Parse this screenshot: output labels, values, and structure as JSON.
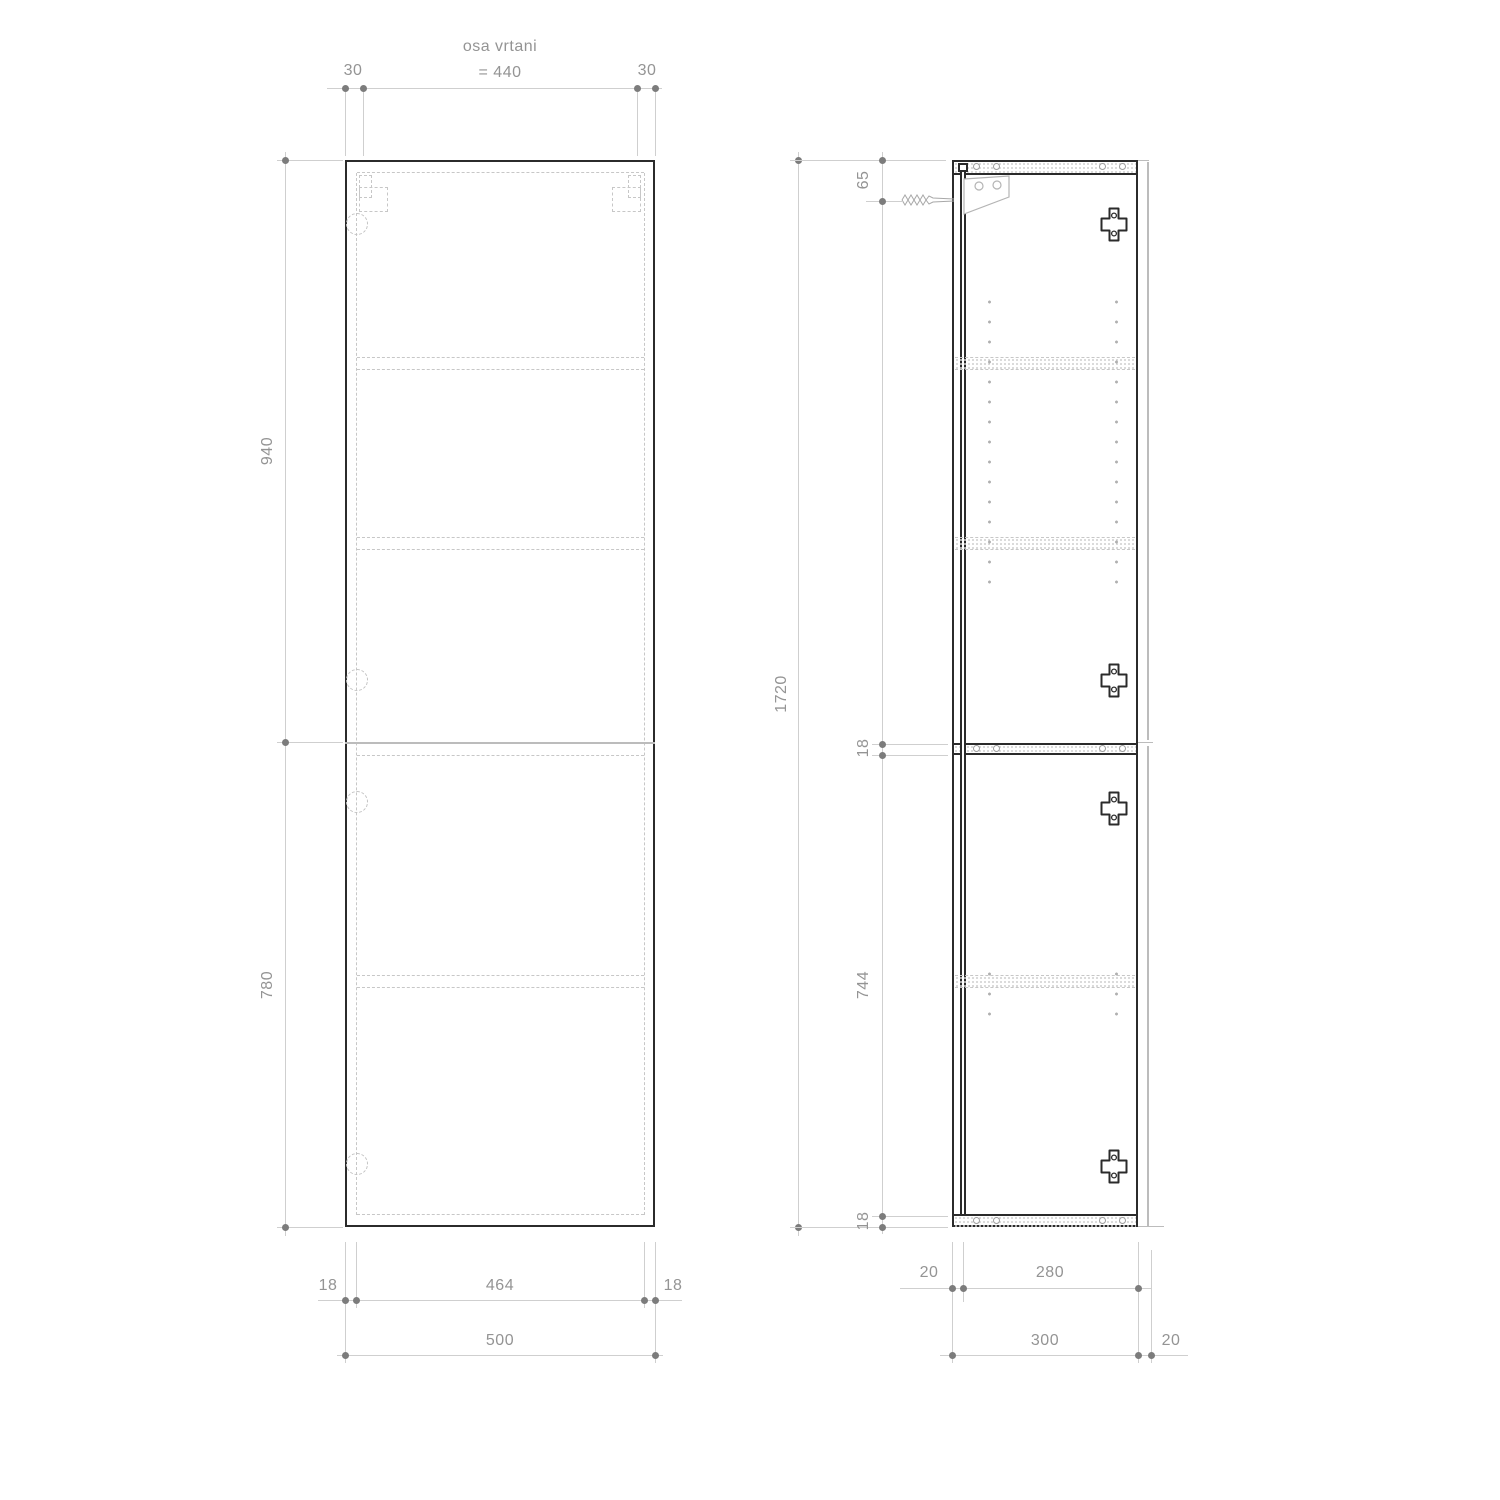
{
  "front_view": {
    "top_dimensions": {
      "left_edge_to_axis": "30",
      "axis_title": "osa vrtani",
      "axis_spacing": "= 440",
      "axis_to_right_edge": "30"
    },
    "side_dimensions": {
      "upper_door_height": "940",
      "lower_door_height": "780"
    },
    "bottom_dimensions": {
      "left_panel_thickness": "18",
      "inner_width": "464",
      "right_panel_thickness": "18",
      "overall_width": "500"
    }
  },
  "side_view": {
    "overall_height": "1720",
    "right_dimensions": {
      "top_to_mount": "65",
      "divider_thickness": "18",
      "lower_inner_height": "744",
      "bottom_panel_thickness": "18"
    },
    "bottom_dimensions": {
      "back_recess": "20",
      "inner_depth": "280",
      "carcass_depth": "300",
      "door_offset": "20"
    }
  },
  "colors": {
    "outline": "#2b2b2b",
    "hidden_line": "#c7c7c7",
    "dimension_line": "#cfcfcf",
    "dimension_text": "#949494",
    "dimension_dot": "#7c7c7c"
  }
}
